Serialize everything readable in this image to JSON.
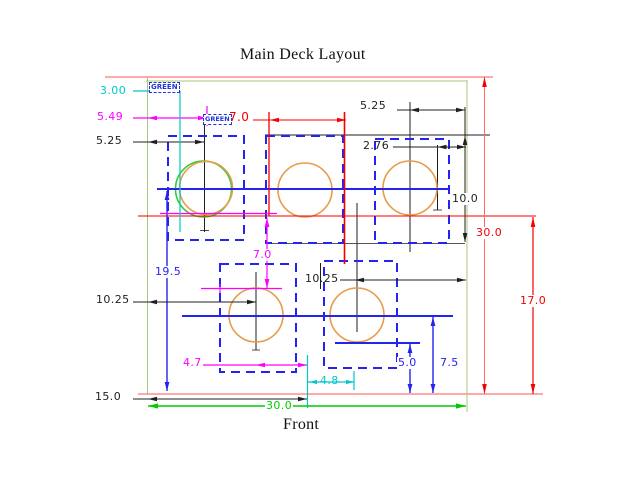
{
  "drawing": {
    "title": "Main Deck Layout",
    "view_label": "Front"
  },
  "tags": {
    "tag1": "GREEN",
    "tag2": "GREEN"
  },
  "dims": {
    "v3_00": "3.00",
    "v5_49": "5.49",
    "v5_25_left": "5.25",
    "v7_0_top": "7.0",
    "v5_25_right": "5.25",
    "v2_76": "2.76",
    "v10_0": "10.0",
    "v30_0_right": "30.0",
    "v17_0": "17.0",
    "v19_5": "19.5",
    "v7_0_middle": "7.0",
    "v10_25_left": "10.25",
    "v10_25_right": "10.25",
    "v4_7": "4.7",
    "v4_8": "4.8",
    "v5_0": "5.0",
    "v7_5": "7.5",
    "v15_0": "15.0",
    "v30_0_bottom": "30.0"
  },
  "palette": {
    "dim_black": "#1f1f1f",
    "dim_red": "#f40000",
    "frame_red_thin": "#ff5555",
    "dim_magenta": "#ff00ff",
    "dim_cyan": "#00c8c8",
    "dim_blue": "#2424f0",
    "dim_green": "#00cc00",
    "deck_outline_green": "#a8c77e",
    "hole_circle_orange": "#e89c4a",
    "hole_circle_green": "#33cc33",
    "tag_blue": "#2233dd"
  }
}
